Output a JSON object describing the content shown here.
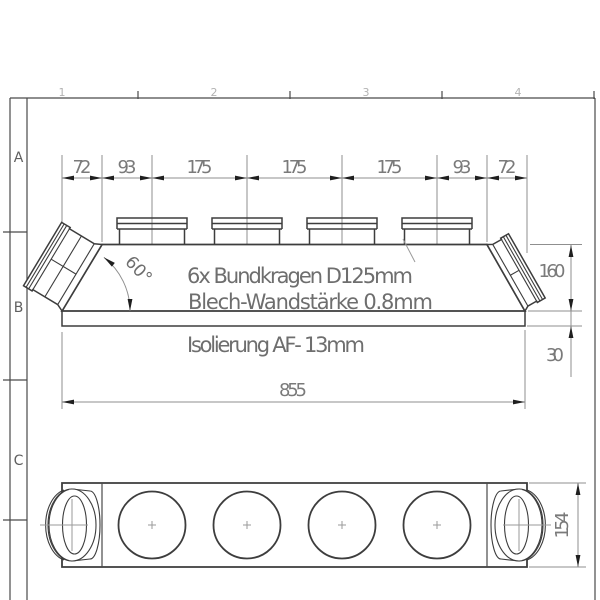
{
  "frame": {
    "rows": [
      "A",
      "B",
      "C"
    ],
    "cols": [
      "1",
      "2",
      "3",
      "4"
    ]
  },
  "dims": {
    "chain": [
      "72",
      "93",
      "175",
      "175",
      "175",
      "93",
      "72"
    ],
    "overall_length": "855",
    "body_height": "160",
    "insulation_offset": "30",
    "depth": "154",
    "angle": "60°"
  },
  "notes": {
    "collars": "6x Bundkragen D125mm",
    "sheet": "Blech-Wandstärke 0.8mm",
    "insulation": "Isolierung AF- 13mm"
  },
  "colors": {
    "outline": "#3d3d3d",
    "dimension": "#8f8f8f",
    "text": "#7a7a7a",
    "arrow": "#1f1f1f",
    "background": "#ffffff"
  }
}
